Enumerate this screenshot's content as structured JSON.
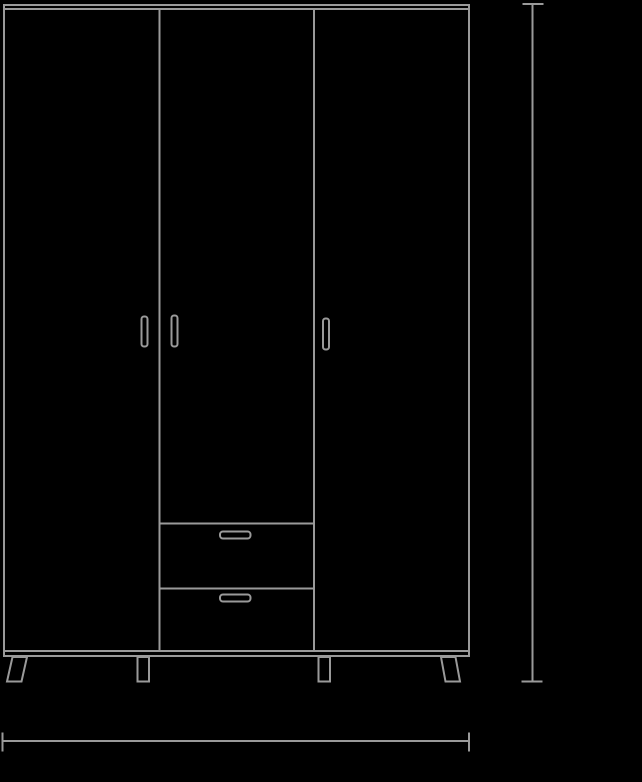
{
  "scene": {
    "type": "technical-line-drawing",
    "subject": "three-door wardrobe with two drawers, front elevation",
    "background_color": "#000000",
    "line_color": "#9a9a9a"
  },
  "drawing": {
    "parts": [
      "wardrobe-outline",
      "top-panel-edge",
      "bottom-panel-edge",
      "door-divider-left",
      "door-divider-right",
      "door-handle-left",
      "door-handle-middle",
      "door-handle-right",
      "drawer-area-top-edge",
      "drawer-divider-edge",
      "drawer-handle-top",
      "drawer-handle-bottom",
      "leg-outer-left",
      "leg-inner-left",
      "leg-inner-right",
      "leg-outer-right"
    ]
  },
  "dimensions": {
    "height_line": {
      "orientation": "vertical",
      "label": ""
    },
    "width_line": {
      "orientation": "horizontal",
      "label": ""
    }
  }
}
